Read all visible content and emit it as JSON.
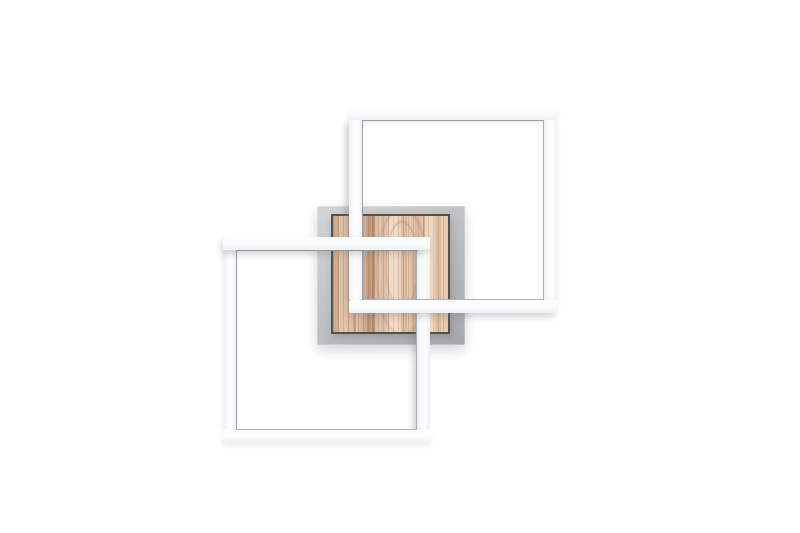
{
  "product": {
    "name": "Modern LED wall lamp with two interlocking white square light frames and a square natural-wood panel on a grey wall-mount backplate",
    "parts": {
      "backplate": "grey square mounting plate",
      "wood_panel": "light natural wood square panel with vertical grain",
      "frame_upper_right": "white square light frame, upper right, woven through the lower frame",
      "frame_lower_left": "white square light frame, lower left, woven through the upper frame"
    }
  },
  "colors": {
    "background": "#ffffff",
    "frame_fill": "#fafbfc",
    "frame_fill_shade": "#eff1f2",
    "frame_inner_line": "#9ba0a4",
    "backplate_light": "#d2d5d7",
    "backplate_dark": "#a6a9ac",
    "wood_border": "#57504a",
    "wood_base": "#e2c0a3",
    "wood_light": "#f1ddc9",
    "wood_mid": "#d7b192",
    "wood_dark": "#bf9678",
    "shadow": "rgba(110,116,122,0.30)"
  }
}
